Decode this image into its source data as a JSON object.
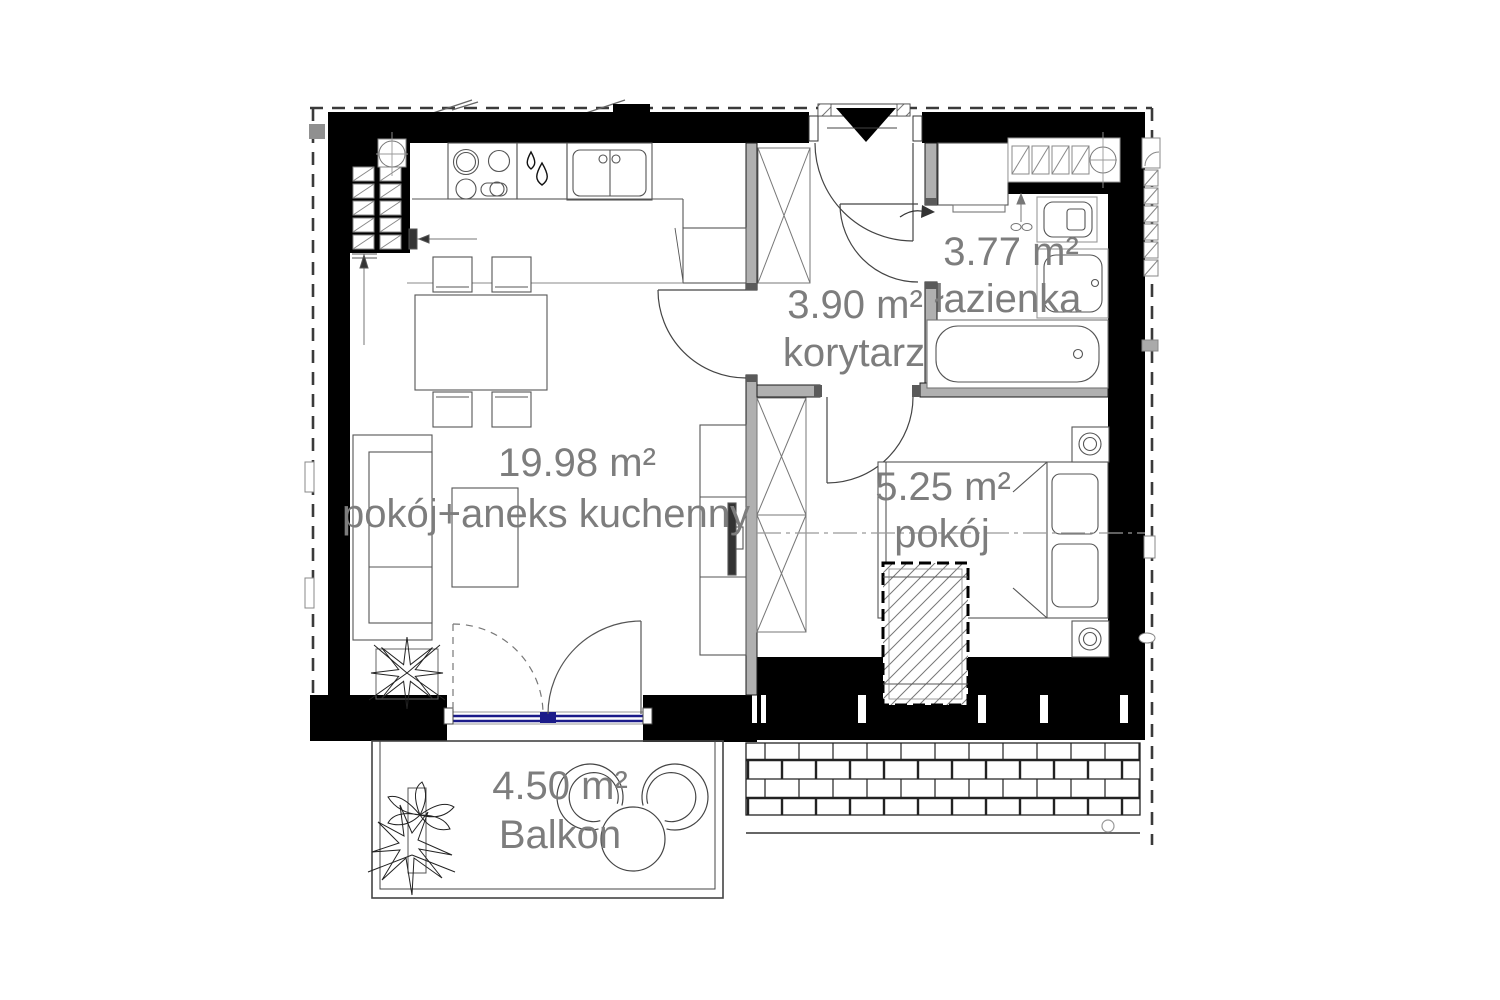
{
  "rooms": [
    {
      "id": "living",
      "area": "19.98 m²",
      "name": "pokój+aneks kuchenny"
    },
    {
      "id": "corridor",
      "area": "3.90 m²",
      "name": "korytarz"
    },
    {
      "id": "bathroom",
      "area": "3.77 m²",
      "name": "łazienka"
    },
    {
      "id": "bedroom",
      "area": "5.25 m²",
      "name": "pokój"
    },
    {
      "id": "balcony",
      "area": "4.50 m²",
      "name": "Balkon"
    }
  ],
  "colors": {
    "walls": "#000000",
    "partition": "#b0b0b0",
    "label_gray": "#7d7d7d",
    "balcony_door_blue": "#1b1b8a",
    "background": "#ffffff"
  }
}
